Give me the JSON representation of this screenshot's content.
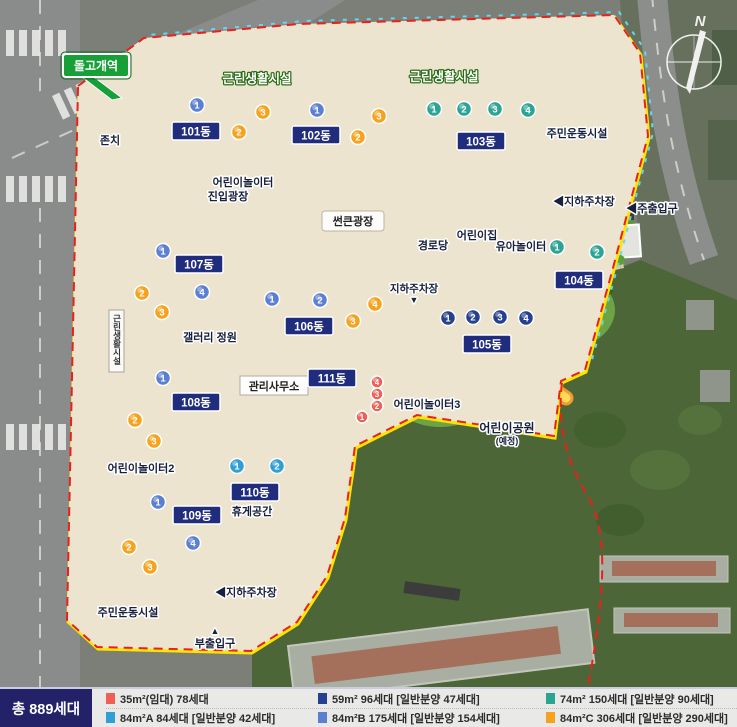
{
  "station": {
    "label": "돌고개역"
  },
  "compass": {
    "n": "N"
  },
  "areas": {
    "entry_plaza": "진입광장",
    "preserved": "존치",
    "retail_top1": "근린생활시설",
    "retail_top2": "근린생활시설",
    "retail_side": "근린생활시설",
    "playground1": "어린이놀이터",
    "playground2": "어린이놀이터2",
    "playground3": "어린이놀이터3",
    "senior_center": "경로당",
    "daycare": "어린이집",
    "toddler_play": "유아놀이터",
    "sports_top": "주민운동시설",
    "sports_bottom": "주민운동시설",
    "sunken_plaza": "썬큰광장",
    "gallery_garden": "갤러리 정원",
    "mgmt_office": "관리사무소",
    "rest_area": "휴게공간",
    "children_park": "어린이공원",
    "children_park_note": "(예정)",
    "parking_topright": "◀지하주차장",
    "parking_mid": "지하주차장",
    "parking_mid_arrow": "▼",
    "parking_bottom": "◀지하주차장",
    "main_gate": "◀주출입구",
    "sub_gate": "부출입구",
    "sub_gate_arrow": "▲"
  },
  "unit_types": {
    "t35": {
      "color": "#ee5f55"
    },
    "t59": {
      "color": "#24408e"
    },
    "t74": {
      "color": "#2aa493"
    },
    "t84A": {
      "color": "#2f9fd4"
    },
    "t84B": {
      "color": "#5b7fd1"
    },
    "t84C": {
      "color": "#f6a21c"
    }
  },
  "buildings": [
    {
      "name": "101동",
      "units": [
        {
          "no": "1",
          "type": "t84B"
        },
        {
          "no": "2",
          "type": "t84C"
        },
        {
          "no": "3",
          "type": "t84C"
        }
      ]
    },
    {
      "name": "102동",
      "units": [
        {
          "no": "1",
          "type": "t84B"
        },
        {
          "no": "2",
          "type": "t84C"
        },
        {
          "no": "3",
          "type": "t84C"
        }
      ]
    },
    {
      "name": "103동",
      "units": [
        {
          "no": "1",
          "type": "t74"
        },
        {
          "no": "2",
          "type": "t74"
        },
        {
          "no": "3",
          "type": "t74"
        },
        {
          "no": "4",
          "type": "t74"
        }
      ]
    },
    {
      "name": "104동",
      "units": [
        {
          "no": "1",
          "type": "t74"
        },
        {
          "no": "2",
          "type": "t74"
        }
      ]
    },
    {
      "name": "105동",
      "units": [
        {
          "no": "1",
          "type": "t59"
        },
        {
          "no": "2",
          "type": "t59"
        },
        {
          "no": "3",
          "type": "t59"
        },
        {
          "no": "4",
          "type": "t59"
        }
      ]
    },
    {
      "name": "106동",
      "units": [
        {
          "no": "1",
          "type": "t84B"
        },
        {
          "no": "2",
          "type": "t84B"
        },
        {
          "no": "3",
          "type": "t84C"
        },
        {
          "no": "4",
          "type": "t84C"
        }
      ]
    },
    {
      "name": "107동",
      "units": [
        {
          "no": "1",
          "type": "t84B"
        },
        {
          "no": "2",
          "type": "t84C"
        },
        {
          "no": "3",
          "type": "t84C"
        },
        {
          "no": "4",
          "type": "t84B"
        }
      ]
    },
    {
      "name": "108동",
      "units": [
        {
          "no": "1",
          "type": "t84B"
        },
        {
          "no": "2",
          "type": "t84C"
        },
        {
          "no": "3",
          "type": "t84C"
        }
      ]
    },
    {
      "name": "109동",
      "units": [
        {
          "no": "1",
          "type": "t84B"
        },
        {
          "no": "2",
          "type": "t84C"
        },
        {
          "no": "3",
          "type": "t84C"
        },
        {
          "no": "4",
          "type": "t84B"
        }
      ]
    },
    {
      "name": "110동",
      "units": [
        {
          "no": "1",
          "type": "t84A"
        },
        {
          "no": "2",
          "type": "t84A"
        }
      ]
    },
    {
      "name": "111동",
      "units": [
        {
          "no": "1",
          "type": "t35"
        },
        {
          "no": "2",
          "type": "t35"
        },
        {
          "no": "3",
          "type": "t35"
        },
        {
          "no": "4",
          "type": "t35"
        }
      ]
    }
  ],
  "legend": {
    "total": "총 889세대",
    "rows": [
      [
        {
          "type": "t35",
          "text": "35m²(임대) 78세대"
        },
        {
          "type": "t59",
          "text": "59m² 96세대 [일반분양 47세대]"
        },
        {
          "type": "t74",
          "text": "74m² 150세대 [일반분양 90세대]"
        }
      ],
      [
        {
          "type": "t84A",
          "text": "84m²A 84세대 [일반분양 42세대]"
        },
        {
          "type": "t84B",
          "text": "84m²B 175세대 [일반분양 154세대]"
        },
        {
          "type": "t84C",
          "text": "84m²C 306세대 [일반분양 290세대]"
        }
      ]
    ]
  }
}
